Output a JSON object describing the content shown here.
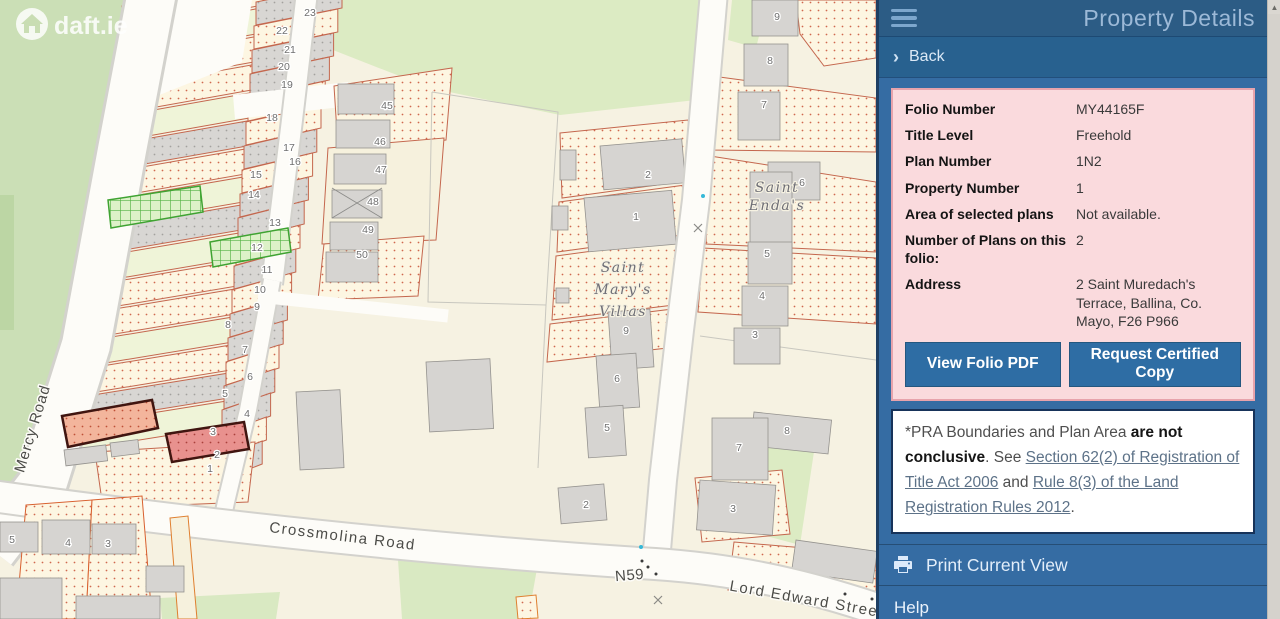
{
  "panel": {
    "title": "Property Details",
    "back_label": "Back",
    "details": {
      "rows": [
        {
          "label": "Folio Number",
          "value": "MY44165F"
        },
        {
          "label": "Title Level",
          "value": "Freehold"
        },
        {
          "label": "Plan Number",
          "value": "1N2"
        },
        {
          "label": "Property Number",
          "value": "1"
        },
        {
          "label": "Area of selected plans",
          "value": "Not available."
        },
        {
          "label": "Number of Plans on this folio:",
          "value": "2"
        },
        {
          "label": "Address",
          "value": "2 Saint Muredach's Terrace, Ballina, Co. Mayo, F26 P966"
        }
      ],
      "buttons": [
        {
          "label": "View Folio PDF"
        },
        {
          "label": "Request Certified Copy"
        }
      ]
    },
    "disclaimer": {
      "prefix": " *PRA Boundaries and Plan Area ",
      "bold1": "are not conclusive",
      "mid1": ". See ",
      "link1": "Section 62(2) of Registration of Title Act 2006",
      "mid2": " and ",
      "link2": "Rule 8(3) of the Land Registration Rules 2012",
      "suffix": "."
    },
    "print_label": "Print Current View",
    "help_label": "Help"
  },
  "map": {
    "logo_text": "daft.ie",
    "road_labels": [
      {
        "text": "Mercy Road",
        "x": 37,
        "y": 430,
        "rotate": -73,
        "size": 15,
        "spacing": 1
      },
      {
        "text": "Crossmolina Road",
        "x": 342,
        "y": 541,
        "rotate": 7,
        "size": 15,
        "spacing": 1.5
      },
      {
        "text": "N59",
        "x": 630,
        "y": 580,
        "rotate": -5,
        "size": 13,
        "spacing": 0.5
      },
      {
        "text": "Lord Edward Street",
        "x": 806,
        "y": 604,
        "rotate": 10,
        "size": 15,
        "spacing": 1.5
      }
    ],
    "place_labels": [
      {
        "lines": [
          "Saint",
          "Mary's",
          "Villas"
        ],
        "x": 623,
        "y": 272,
        "lh": 22,
        "size": 14
      },
      {
        "lines": [
          "Saint",
          "Enda's"
        ],
        "x": 777,
        "y": 192,
        "lh": 18,
        "size": 12.5
      }
    ],
    "parcel_numbers": [
      {
        "n": "23",
        "x": 310,
        "y": 16
      },
      {
        "n": "22",
        "x": 282,
        "y": 34
      },
      {
        "n": "21",
        "x": 290,
        "y": 53
      },
      {
        "n": "20",
        "x": 284,
        "y": 70
      },
      {
        "n": "19",
        "x": 287,
        "y": 88
      },
      {
        "n": "18",
        "x": 272,
        "y": 121
      },
      {
        "n": "17",
        "x": 289,
        "y": 151
      },
      {
        "n": "16",
        "x": 295,
        "y": 165
      },
      {
        "n": "15",
        "x": 256,
        "y": 178
      },
      {
        "n": "14",
        "x": 254,
        "y": 198
      },
      {
        "n": "13",
        "x": 275,
        "y": 226
      },
      {
        "n": "12",
        "x": 257,
        "y": 251
      },
      {
        "n": "11",
        "x": 267,
        "y": 273
      },
      {
        "n": "10",
        "x": 260,
        "y": 293
      },
      {
        "n": "9",
        "x": 257,
        "y": 310
      },
      {
        "n": "8",
        "x": 228,
        "y": 328
      },
      {
        "n": "7",
        "x": 245,
        "y": 353
      },
      {
        "n": "6",
        "x": 250,
        "y": 380
      },
      {
        "n": "5",
        "x": 225,
        "y": 397
      },
      {
        "n": "4",
        "x": 247,
        "y": 417
      },
      {
        "n": "3",
        "x": 213,
        "y": 435
      },
      {
        "n": "2",
        "x": 217,
        "y": 458
      },
      {
        "n": "1",
        "x": 210,
        "y": 472
      },
      {
        "n": "45",
        "x": 387,
        "y": 109
      },
      {
        "n": "46",
        "x": 380,
        "y": 145
      },
      {
        "n": "47",
        "x": 381,
        "y": 173
      },
      {
        "n": "48",
        "x": 373,
        "y": 205
      },
      {
        "n": "49",
        "x": 368,
        "y": 233
      },
      {
        "n": "50",
        "x": 362,
        "y": 258
      },
      {
        "n": "2",
        "x": 648,
        "y": 178
      },
      {
        "n": "1",
        "x": 636,
        "y": 220
      },
      {
        "n": "9",
        "x": 626,
        "y": 334
      },
      {
        "n": "6",
        "x": 617,
        "y": 382
      },
      {
        "n": "5",
        "x": 607,
        "y": 431
      },
      {
        "n": "2",
        "x": 586,
        "y": 508
      },
      {
        "n": "3",
        "x": 733,
        "y": 512
      },
      {
        "n": "9",
        "x": 777,
        "y": 20
      },
      {
        "n": "8",
        "x": 770,
        "y": 64
      },
      {
        "n": "7",
        "x": 764,
        "y": 108
      },
      {
        "n": "6",
        "x": 802,
        "y": 186
      },
      {
        "n": "5",
        "x": 767,
        "y": 257
      },
      {
        "n": "4",
        "x": 762,
        "y": 299
      },
      {
        "n": "3",
        "x": 755,
        "y": 338
      },
      {
        "n": "8",
        "x": 787,
        "y": 434
      },
      {
        "n": "7",
        "x": 739,
        "y": 451
      },
      {
        "n": "5",
        "x": 12,
        "y": 543
      },
      {
        "n": "4",
        "x": 68,
        "y": 546
      },
      {
        "n": "3",
        "x": 108,
        "y": 547
      }
    ]
  },
  "colors": {
    "panel_header": "#2c5c85",
    "panel_back": "#28618f",
    "panel_body": "#356ca3",
    "accent_button": "#2e6da4",
    "details_bg": "#fadadd",
    "details_border": "#e7a3ac",
    "highlight_salmon": "#f3b59c",
    "highlight_pink": "#e8918e",
    "selected_plan_green": "#54b244",
    "parcel_stroke": "#c4674e"
  }
}
